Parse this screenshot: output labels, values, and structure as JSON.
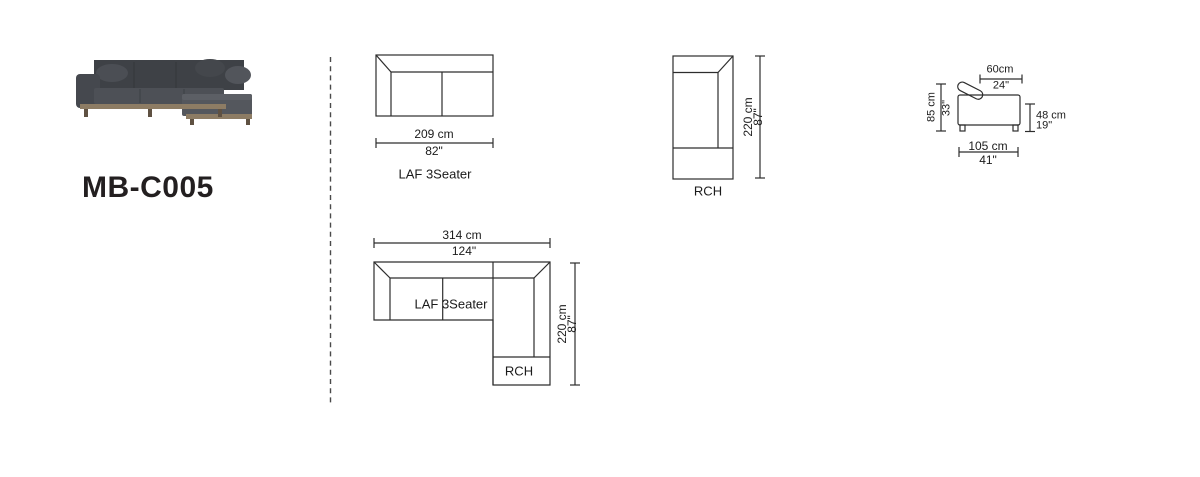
{
  "title": {
    "model": "MB-C005"
  },
  "colors": {
    "line": "#2d2d2d",
    "text": "#1b1b1b",
    "title_text": "#231f20",
    "sofa_body": "#45484e",
    "sofa_base_wood": "#8d7c64",
    "divider": "#4a4a4a"
  },
  "diagrams": {
    "laf_top_view": {
      "label": "LAF 3Seater",
      "width_cm": "209 cm",
      "width_in": "82\""
    },
    "rch_top_view": {
      "label": "RCH",
      "depth_cm": "220 cm",
      "depth_in": "87\""
    },
    "side_view": {
      "seat_depth_cm": "60cm",
      "seat_depth_in": "24\"",
      "overall_height_cm": "85 cm",
      "overall_height_in": "33\"",
      "seat_height_cm": "48 cm",
      "seat_height_in": "19\"",
      "overall_depth_cm": "105 cm",
      "overall_depth_in": "41\""
    },
    "combined_top_view": {
      "sofa_label": "LAF 3Seater",
      "chaise_label": "RCH",
      "overall_width_cm": "314 cm",
      "overall_width_in": "124\"",
      "overall_depth_cm": "220 cm",
      "overall_depth_in": "87\""
    }
  }
}
